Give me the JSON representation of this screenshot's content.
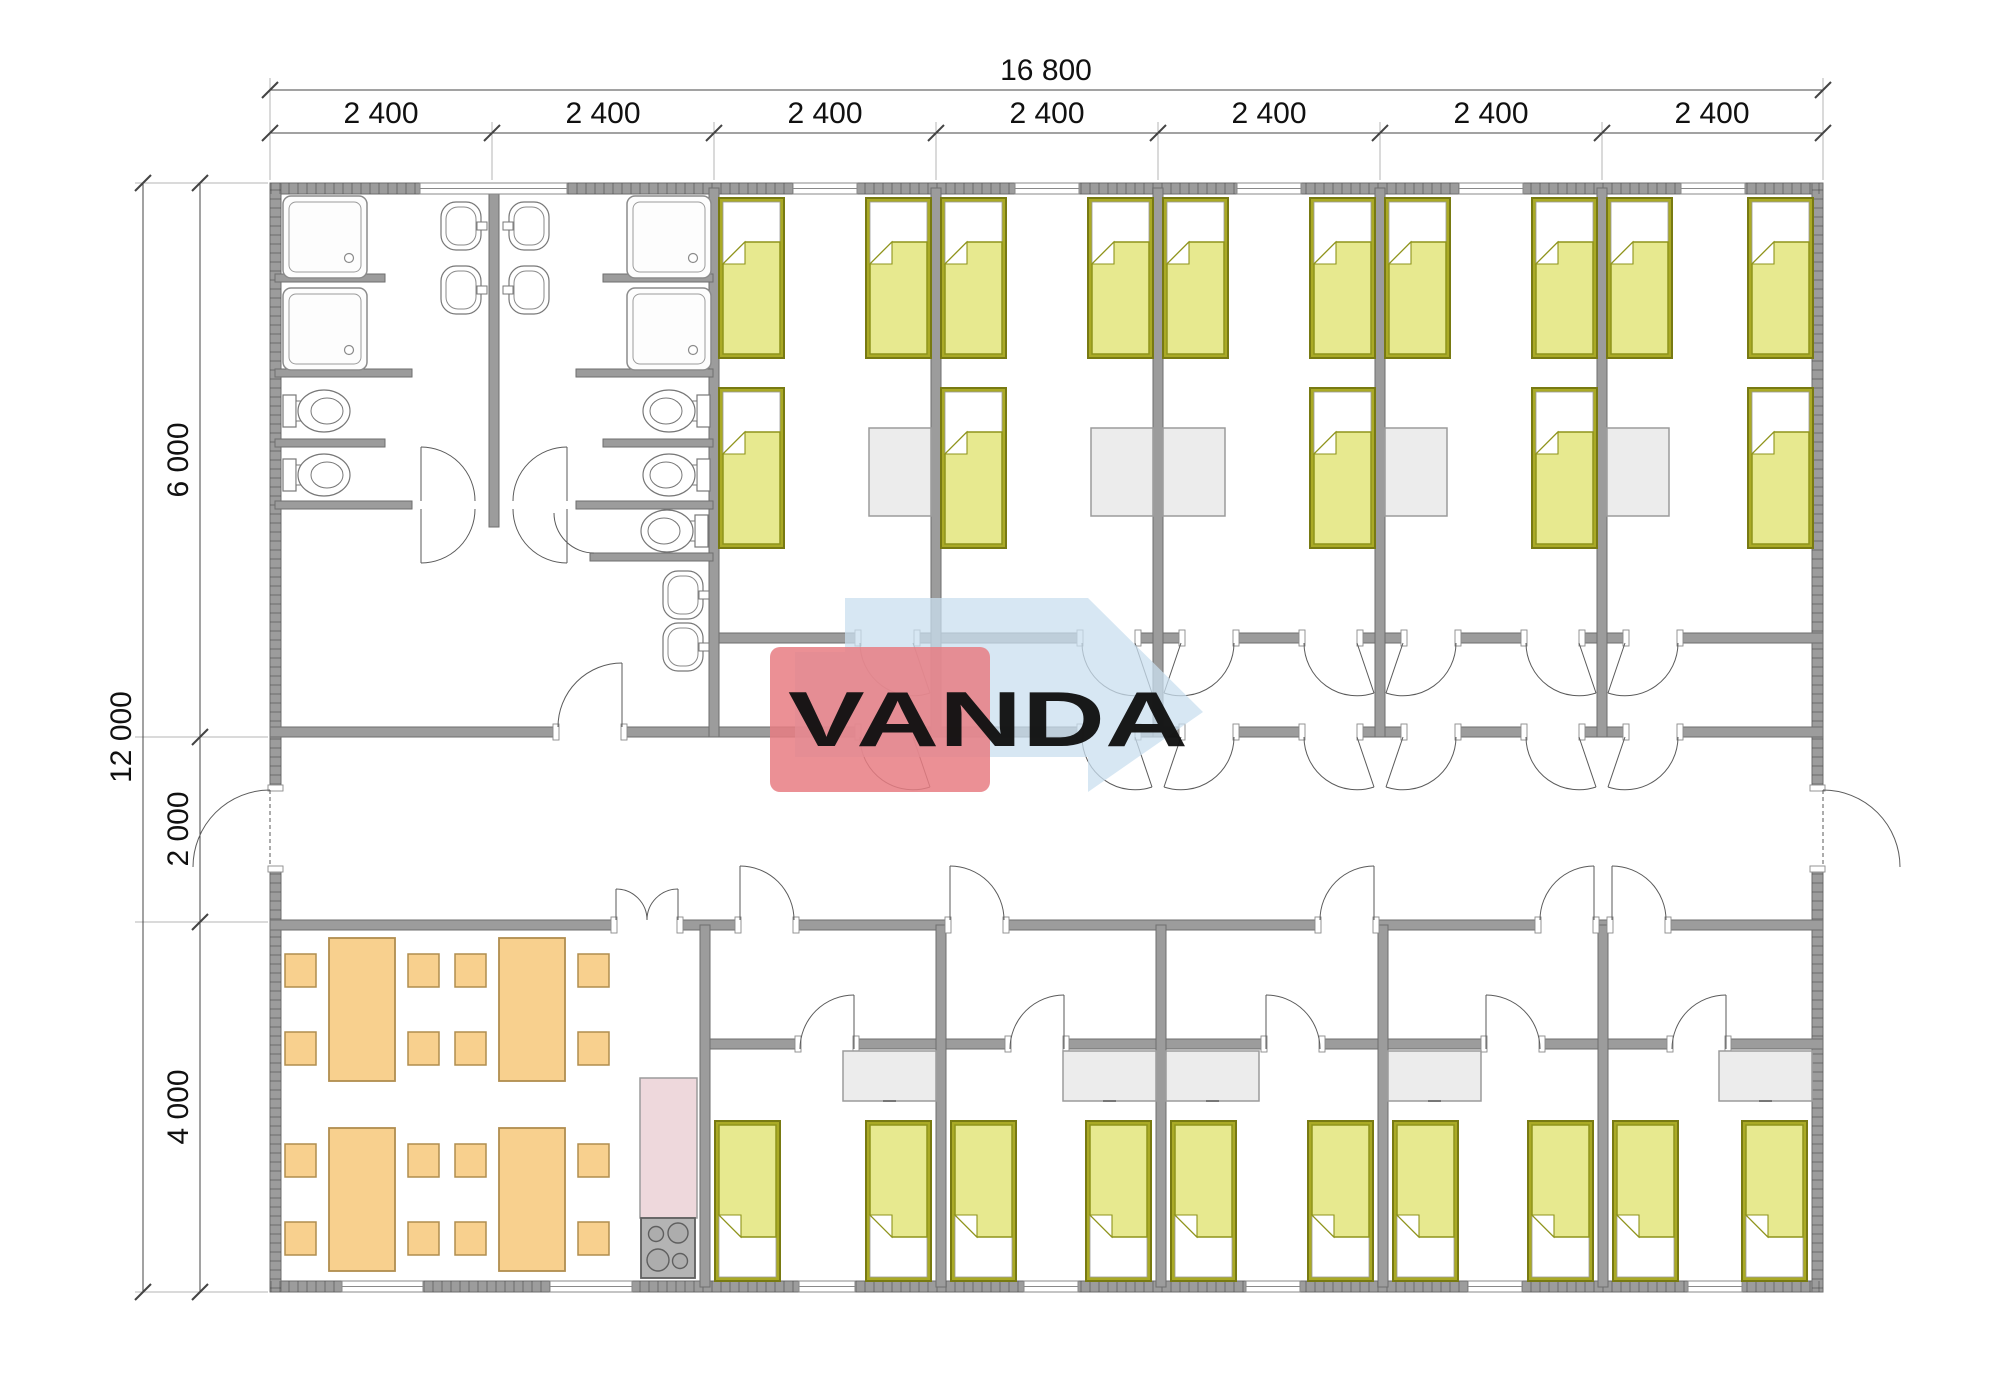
{
  "title": "VANDA modular building floor plan",
  "logo": {
    "text": "VANDA",
    "red": "#e87d82",
    "blue": "#c9dfef",
    "text_color": "#ffffff"
  },
  "dimensions": {
    "overall_width": "16 800",
    "modules": [
      "2 400",
      "2 400",
      "2 400",
      "2 400",
      "2 400",
      "2 400",
      "2 400"
    ],
    "overall_height": "12 000",
    "vertical_segments": [
      "6 000",
      "2 000",
      "4 000"
    ]
  },
  "colors": {
    "wall_fill": "#9c9c9c",
    "wall_stroke": "#6e6e6e",
    "bed_frame": "#aaaa26",
    "bed_blanket": "#e7e98f",
    "furniture_gray": "#ececec",
    "table_orange": "#f8d08e",
    "kitchen_counter_pink": "#eed8dc",
    "stove_gray": "#b4b4b4"
  },
  "inventory": {
    "beds_top_wing": 15,
    "beds_bottom_wing": 10,
    "dining_tables": 4,
    "stools": 16,
    "showers": 4,
    "toilets": 5,
    "sinks": 6,
    "nightstands": 5,
    "wardrobes": 5,
    "stoves": 1
  }
}
